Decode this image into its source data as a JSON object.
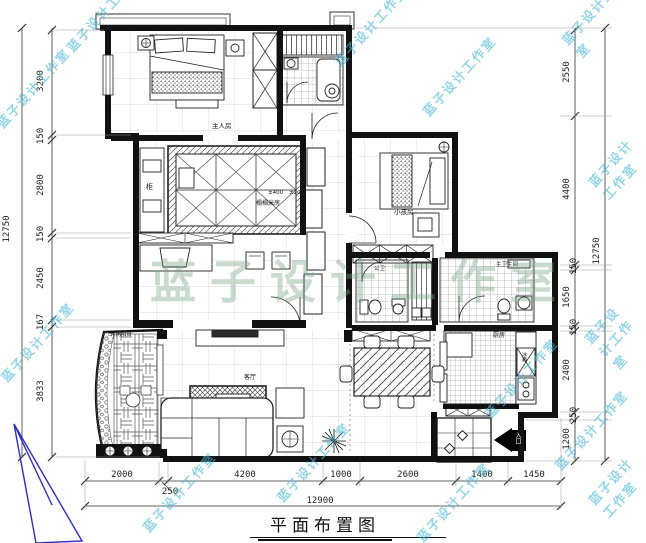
{
  "title": {
    "text": "平面布置图"
  },
  "watermark": {
    "small": "蓝子设计工作室",
    "big": "蓝子设计工作室",
    "color": "#50b9d7"
  },
  "rooms": {
    "master": "主人房",
    "tatami": "榻榻米房",
    "kids": "小孩房",
    "guest_bath": "公卫",
    "master_bath": "主卫生间",
    "kitchen": "厨房",
    "fridge": "冰箱",
    "living": "客厅",
    "balcony": "休闲阳台",
    "cabinet": "柜",
    "entry": "入口",
    "level_a": "±400",
    "level_b": "±200"
  },
  "dimensions": {
    "left": {
      "segments": [
        "3200",
        "150",
        "2800",
        "150",
        "2450",
        "167",
        "3833"
      ],
      "total": "12750"
    },
    "right": {
      "segments": [
        "2550",
        "4400",
        "150",
        "1650",
        "150",
        "2400",
        "250",
        "1200"
      ],
      "total": "12750"
    },
    "bottom": {
      "segments": [
        "2000",
        "250",
        "4200",
        "1000",
        "2600",
        "1400",
        "1450"
      ],
      "total": "12900"
    }
  }
}
